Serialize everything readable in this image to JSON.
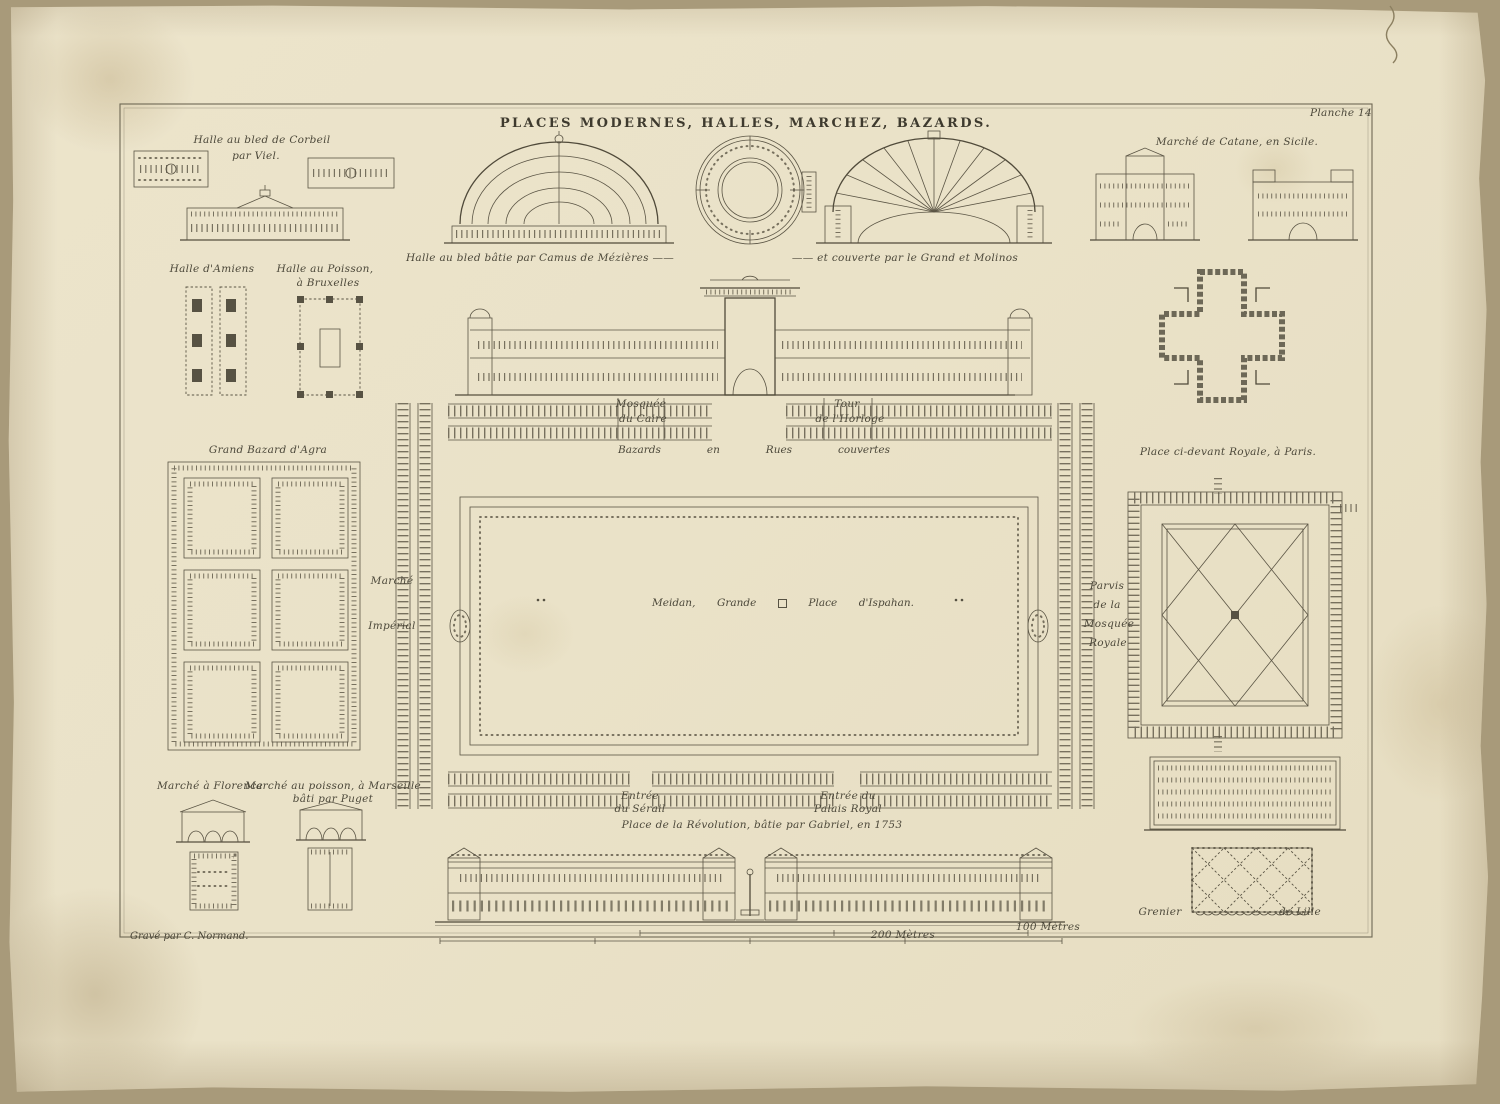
{
  "palette": {
    "paper": "#e9e1c8",
    "ink": "#57523f",
    "frame": "#6e6854"
  },
  "plate": {
    "number": "Planche 14",
    "title": "PLACES MODERNES, HALLES, MARCHEZ, BAZARDS.",
    "engraver": "Gravé par C. Normand."
  },
  "scale": {
    "m100": "100 Mètres",
    "m200": "200 Mètres"
  },
  "sections": {
    "corbeil": {
      "title": "Halle au bled de Corbeil",
      "subtitle": "par Viel."
    },
    "amiens": {
      "title": "Halle d'Amiens"
    },
    "bruxelles": {
      "line1": "Halle au Poisson,",
      "line2": "à Bruxelles"
    },
    "halle_au_bled": {
      "left": "Halle au bled bâtie par Camus de Mézières ——",
      "right": "—— et couverte par le Grand et Molinos"
    },
    "catane": {
      "title": "Marché de Catane, en Sicile."
    },
    "agra": {
      "title": "Grand Bazard d'Agra"
    },
    "meidan": {
      "mosque1": "Mosquée",
      "mosque2": "du Caire",
      "tour1": "Tour",
      "tour2": "de l'Horloge",
      "bazards": [
        "Bazards",
        "en",
        "Rues",
        "couvertes"
      ],
      "marche1": "Marché",
      "marche2": "Impérial",
      "center": [
        "Meidan,",
        "Grande",
        "Place",
        "d'Ispahan."
      ],
      "parvis": [
        "Parvis",
        "de la",
        "Mosquée",
        "Royale"
      ],
      "serail1": "Entrée",
      "serail2": "du Sérail",
      "palais1": "Entrée du",
      "palais2": "Palais Royal"
    },
    "place_royale": {
      "title": "Place ci-devant Royale, à Paris."
    },
    "florence": {
      "title": "Marché à Florence"
    },
    "marseille": {
      "line1": "Marché au poisson, à Marseille",
      "line2": "bâti par Puget"
    },
    "revolution": {
      "title": "Place de la Révolution, bâtie par Gabriel, en 1753"
    },
    "grenier": {
      "left": "Grenier",
      "right": "de Lille"
    }
  }
}
